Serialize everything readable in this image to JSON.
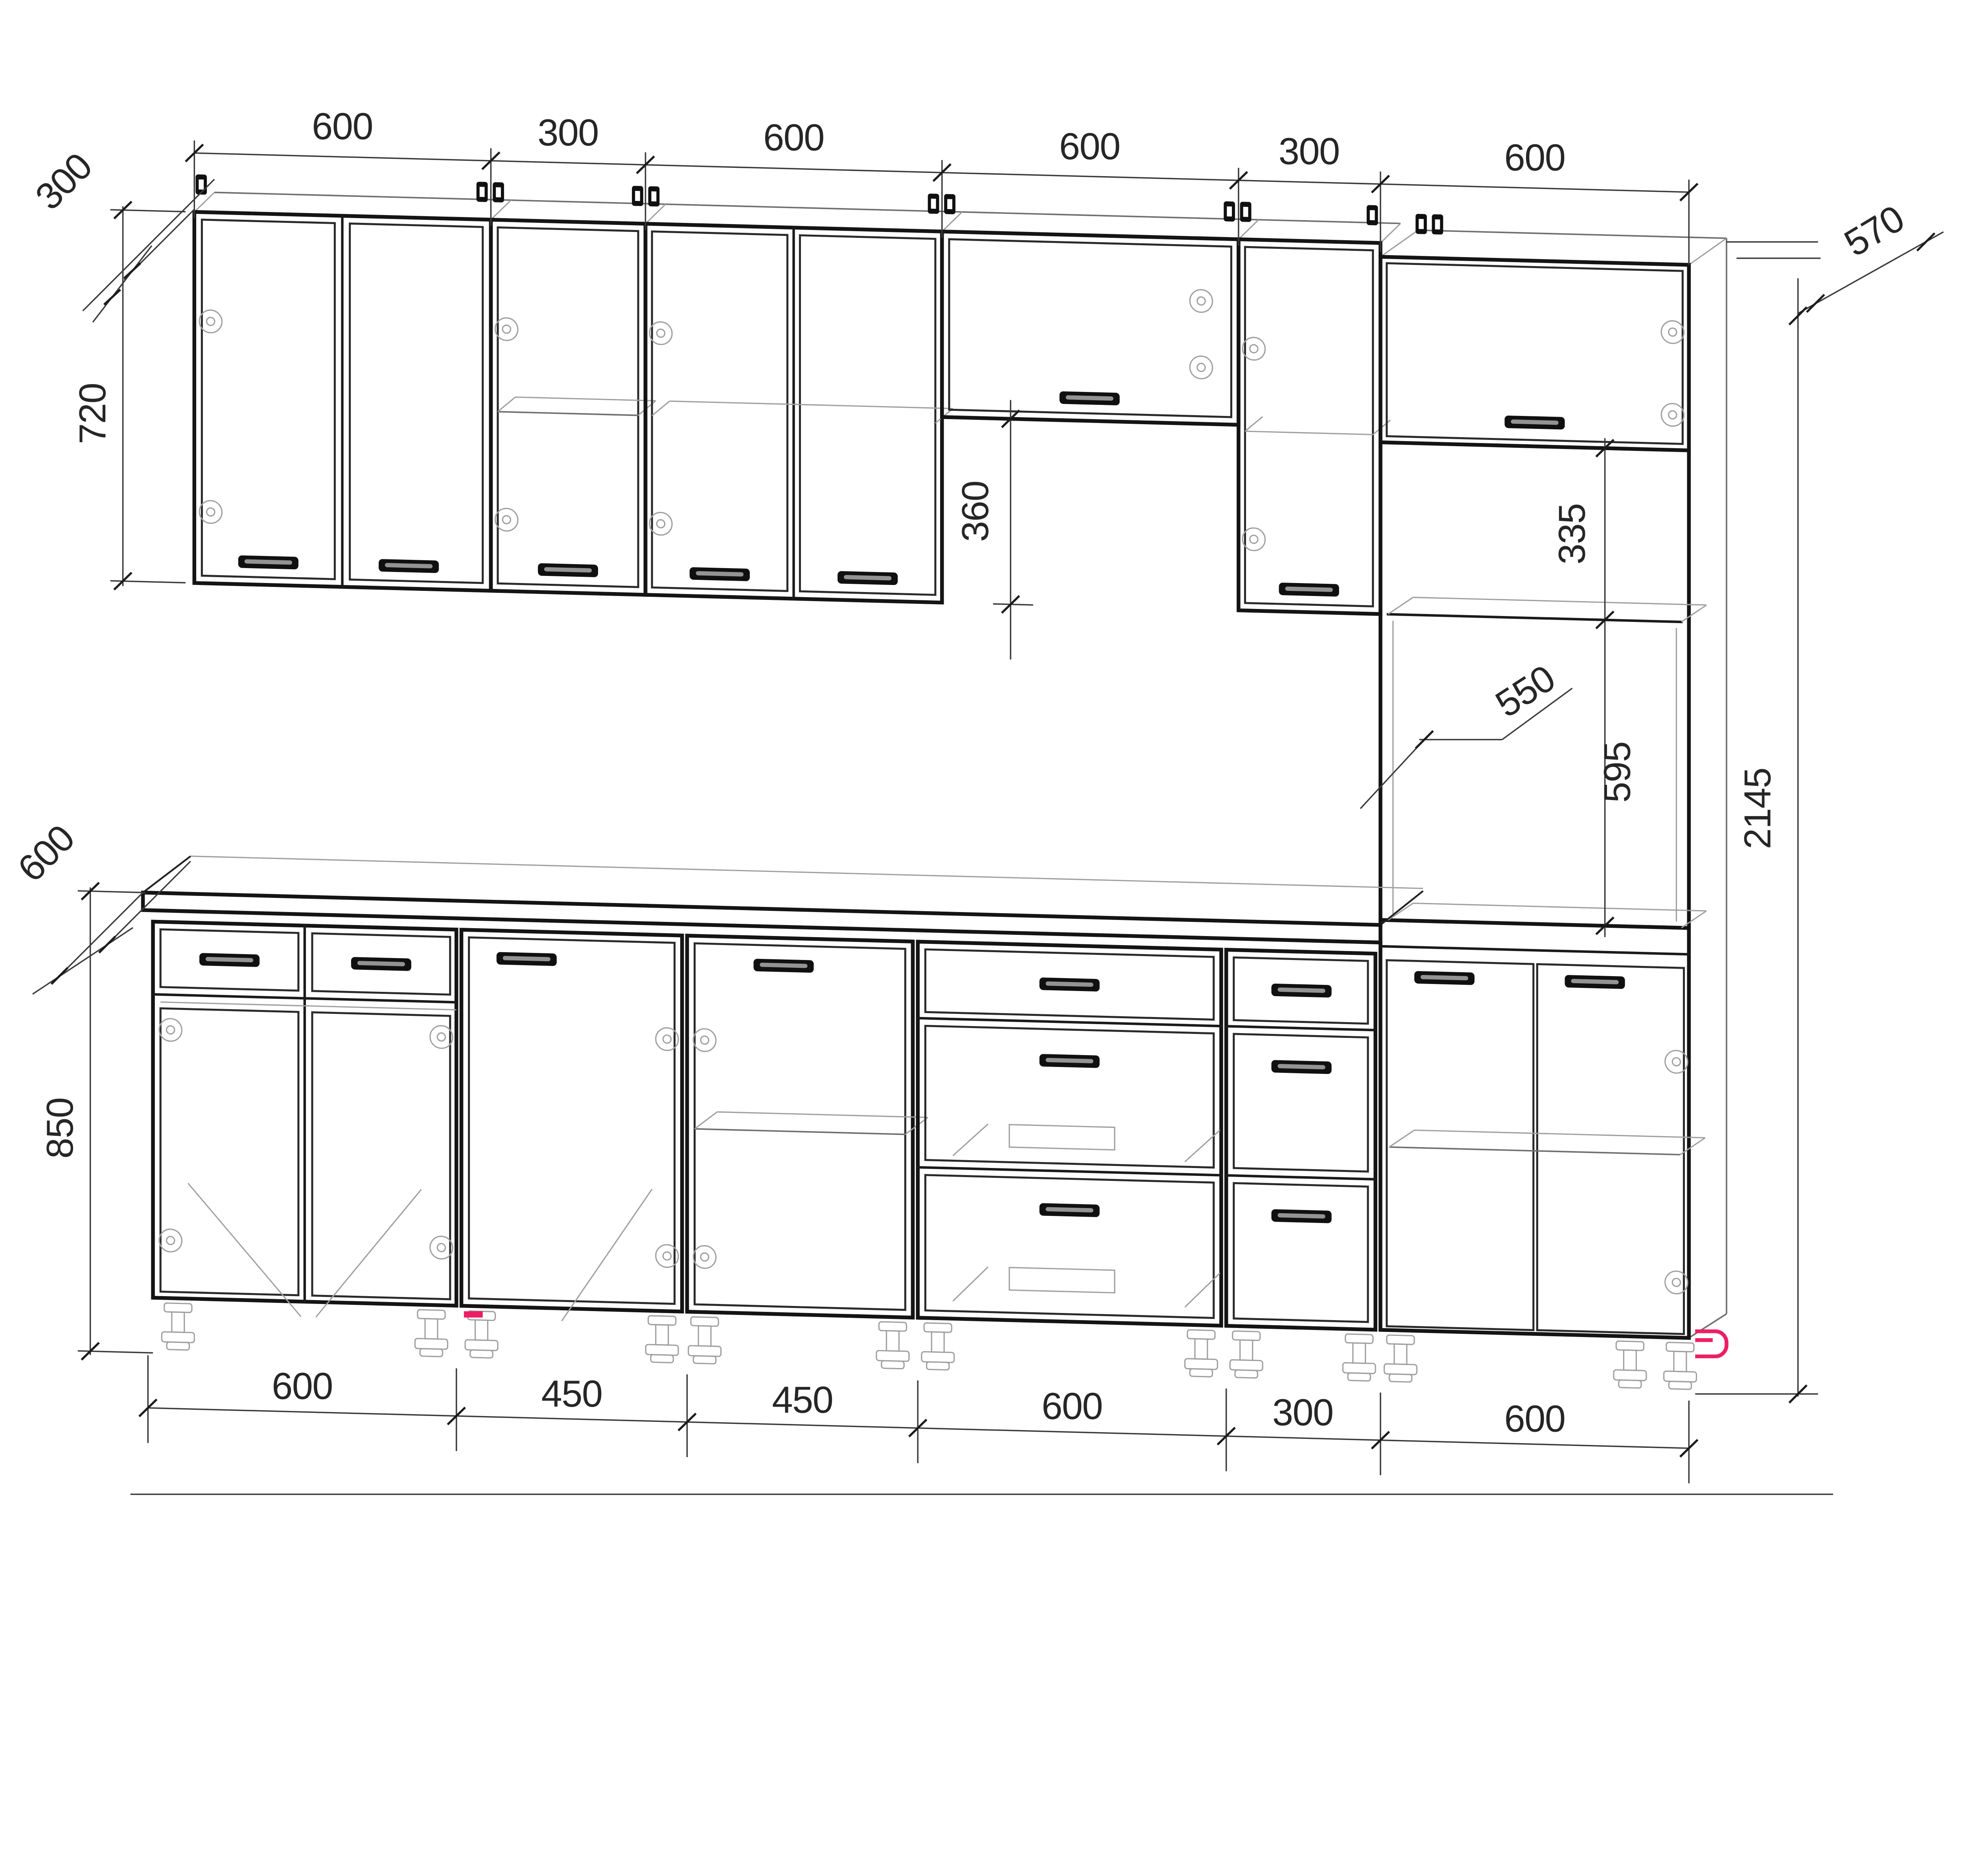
{
  "diagram": {
    "kind": "kitchen cabinet set dimension drawing",
    "units": "mm",
    "dimensions": {
      "top": [
        "600",
        "300",
        "600",
        "600",
        "300",
        "600"
      ],
      "bottom": [
        "600",
        "450",
        "450",
        "600",
        "300",
        "600"
      ],
      "wall_depth": "300",
      "wall_height": "720",
      "base_depth": "600",
      "base_height": "850",
      "hood_gap": "360",
      "tall_depth": "570",
      "tall_niche": "335",
      "tall_inner_width": "550",
      "tall_oven": "595",
      "tall_total_height": "2145"
    },
    "style": {
      "line_color": "#141414",
      "wireframe_color": "#9f9f9f",
      "accent_pink": "#ed1e63",
      "background": "#ffffff"
    }
  }
}
